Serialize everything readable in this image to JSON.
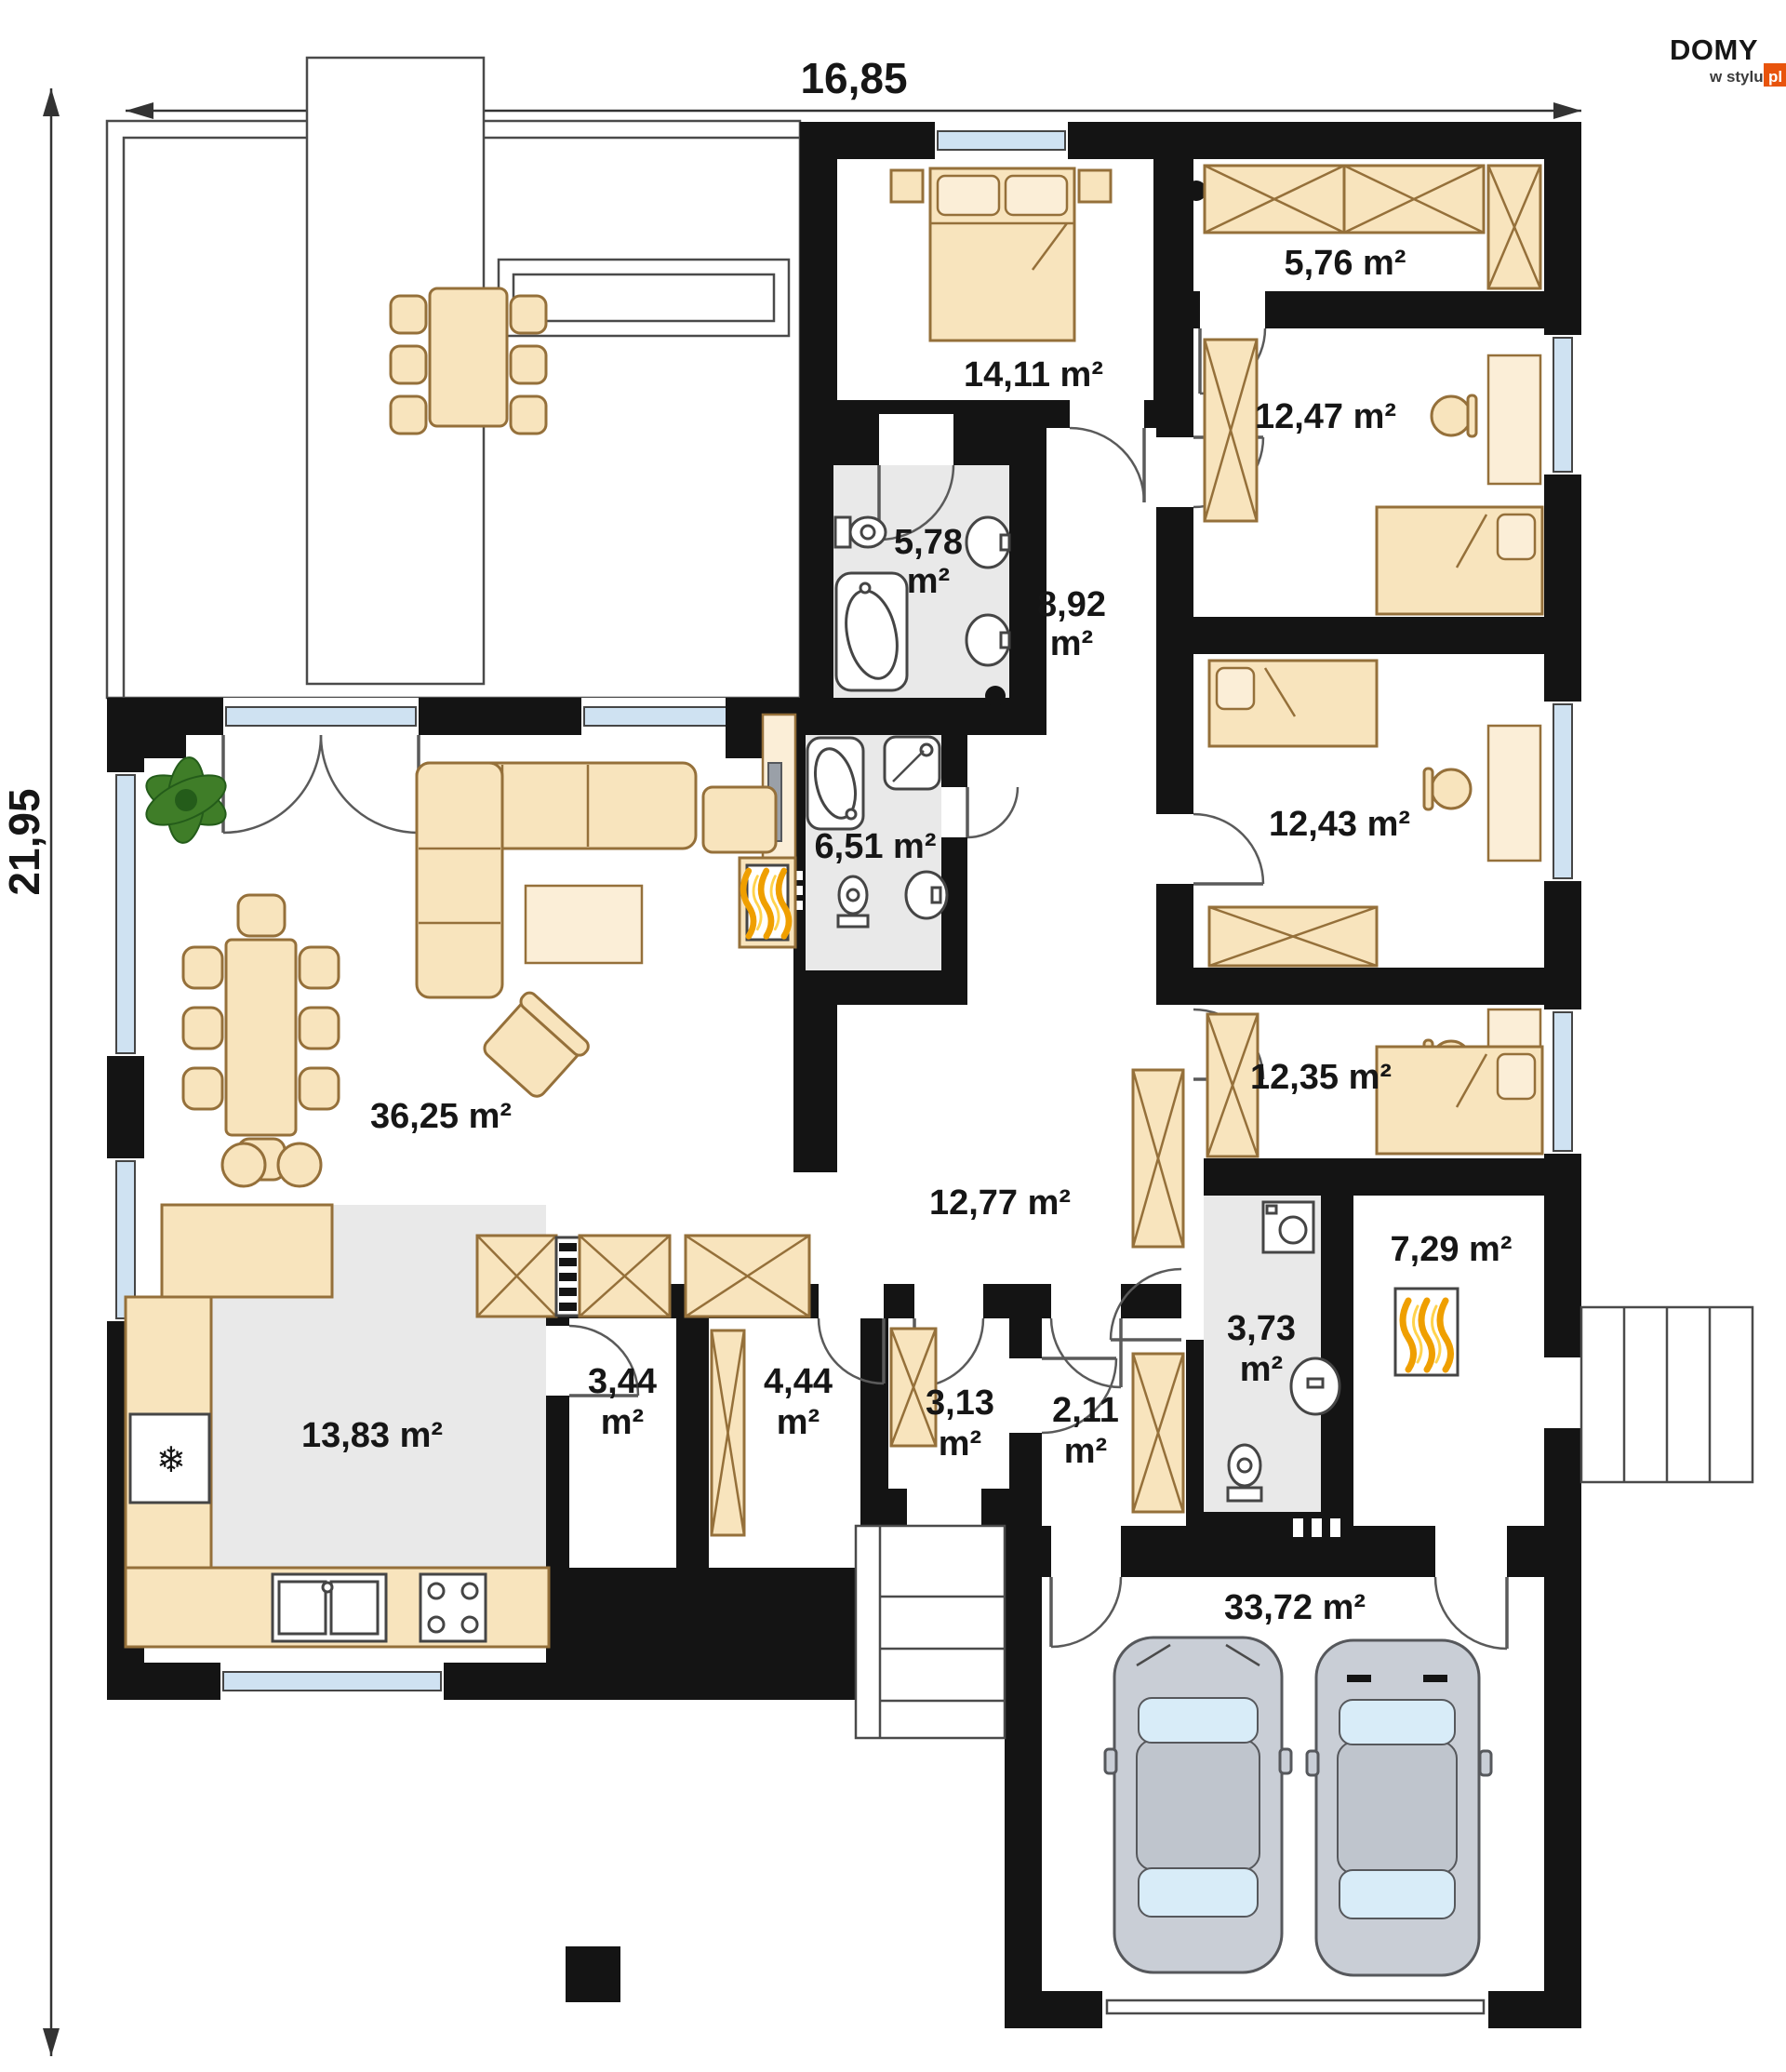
{
  "brand": {
    "name": "DOMY",
    "sub": "w stylu",
    "tld": "pl"
  },
  "dimensions": {
    "total_width_m": "16,85",
    "total_height_m": "21,95"
  },
  "rooms": {
    "master_bedroom": {
      "label": "14,11 m²"
    },
    "walk_in_closet": {
      "label": "5,76 m²"
    },
    "bedroom_1": {
      "label": "12,47 m²"
    },
    "ensuite_bath": {
      "value": "5,78",
      "unit": "m²"
    },
    "hall_upper": {
      "value": "8,92",
      "unit": "m²"
    },
    "bedroom_2": {
      "label": "12,43 m²"
    },
    "bathroom": {
      "label": "6,51 m²"
    },
    "living_room": {
      "label": "36,25 m²"
    },
    "bedroom_3": {
      "label": "12,35 m²"
    },
    "corridor": {
      "label": "12,77 m²"
    },
    "kitchen": {
      "label": "13,83 m²"
    },
    "pantry": {
      "value": "3,44",
      "unit": "m²"
    },
    "closet": {
      "value": "4,44",
      "unit": "m²"
    },
    "vestibule": {
      "value": "3,13",
      "unit": "m²"
    },
    "hall_small": {
      "value": "2,11",
      "unit": "m²"
    },
    "wc": {
      "value": "3,73",
      "unit": "m²"
    },
    "boiler_room": {
      "label": "7,29 m²"
    },
    "garage": {
      "label": "33,72 m²"
    }
  },
  "colors": {
    "wall": "#141414",
    "furniture": "#f8e4bd",
    "wet_floor": "#e9e9e9",
    "glass": "#cfe2f2",
    "brand_accent": "#e8540c",
    "flame": "#ef9f00"
  }
}
